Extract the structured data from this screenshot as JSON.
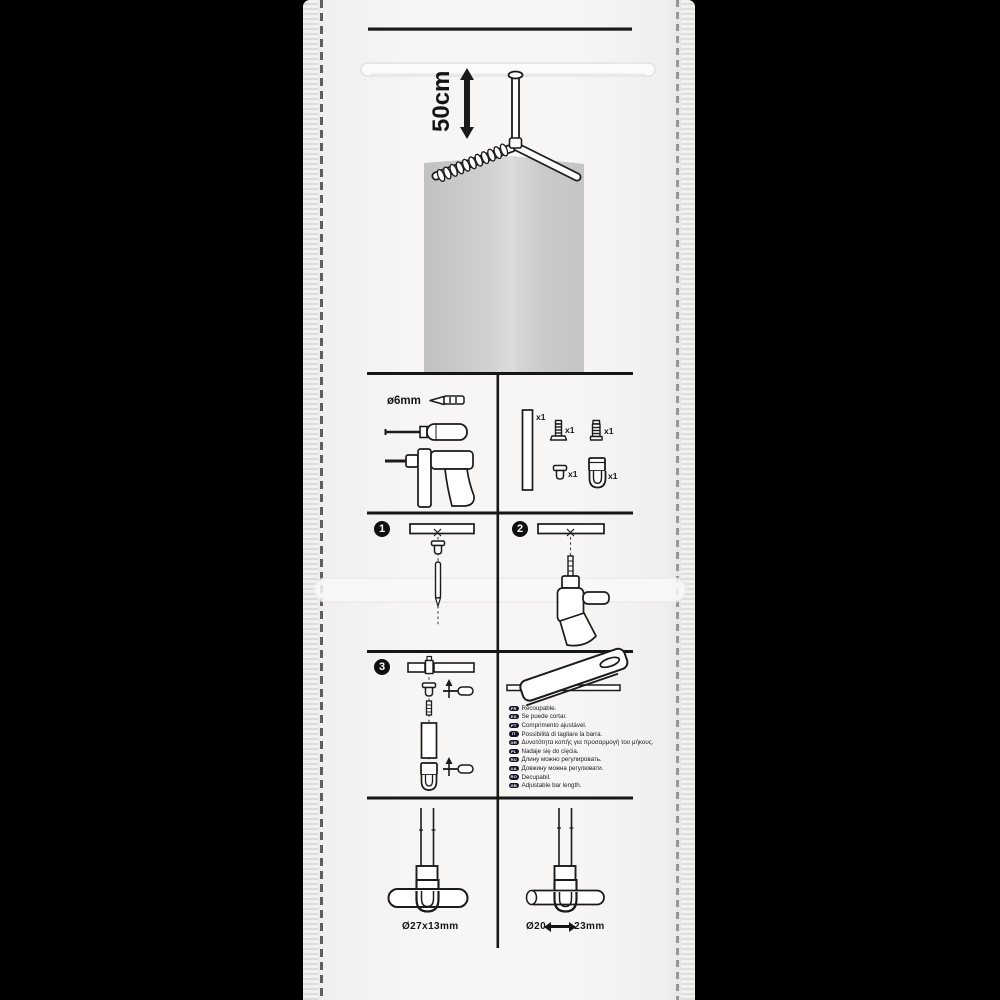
{
  "package": {
    "type": "blister-instruction-panel"
  },
  "hero": {
    "dimension_label": "50cm",
    "icons": [
      "corner-curtain-rod",
      "ceiling-support",
      "curtain-rings",
      "corner-walls",
      "height-arrow"
    ]
  },
  "tools": {
    "drill_diameter_label": "ø6mm",
    "icons": [
      "drill-bit-icon",
      "screwdriver-icon",
      "power-drill-icon"
    ]
  },
  "parts": {
    "items": [
      {
        "name": "wall-bar",
        "qty": "x1"
      },
      {
        "name": "screw",
        "qty": "x1"
      },
      {
        "name": "wall-plug",
        "qty": "x1"
      },
      {
        "name": "end-cap",
        "qty": "x1"
      },
      {
        "name": "hook-bracket",
        "qty": "x1"
      }
    ]
  },
  "steps": [
    {
      "number": "1",
      "icons": [
        "ceiling-bar",
        "x-mark",
        "end-cap",
        "pencil-icon"
      ]
    },
    {
      "number": "2",
      "icons": [
        "ceiling-bar",
        "x-mark",
        "power-drill-icon"
      ]
    },
    {
      "number": "3",
      "icons": [
        "ceiling-bar",
        "wall-plug",
        "end-cap",
        "screwdriver-icon",
        "screw",
        "tube",
        "hook-bracket",
        "up-arrow"
      ]
    }
  ],
  "cutting": {
    "icons": [
      "hacksaw-icon",
      "bar"
    ],
    "languages": [
      {
        "code": "FR",
        "text": "Recoupable."
      },
      {
        "code": "ES",
        "text": "Se puede cortar."
      },
      {
        "code": "PT",
        "text": "Comprimento ajustável."
      },
      {
        "code": "IT",
        "text": "Possibilità di tagliare la barra."
      },
      {
        "code": "GR",
        "text": "Δυνατότητα κοπής για προσαρμογή του μήκους."
      },
      {
        "code": "PL",
        "text": "Nadaje się do cięcia."
      },
      {
        "code": "RU",
        "text": "Длину можно регулировать."
      },
      {
        "code": "UA",
        "text": "Довжину можна регулювати."
      },
      {
        "code": "RO",
        "text": "Decupabil."
      },
      {
        "code": "GB",
        "text": "Adjustable bar length."
      }
    ]
  },
  "compatibility": {
    "flat_bar_label": "Ø27x13mm",
    "round_bar_min": "Ø20",
    "round_bar_max": "23mm"
  },
  "colors": {
    "background": "#000000",
    "package": "#f5f4f2",
    "ink": "#1b1b1b",
    "wall_gray": "#cccccb"
  }
}
